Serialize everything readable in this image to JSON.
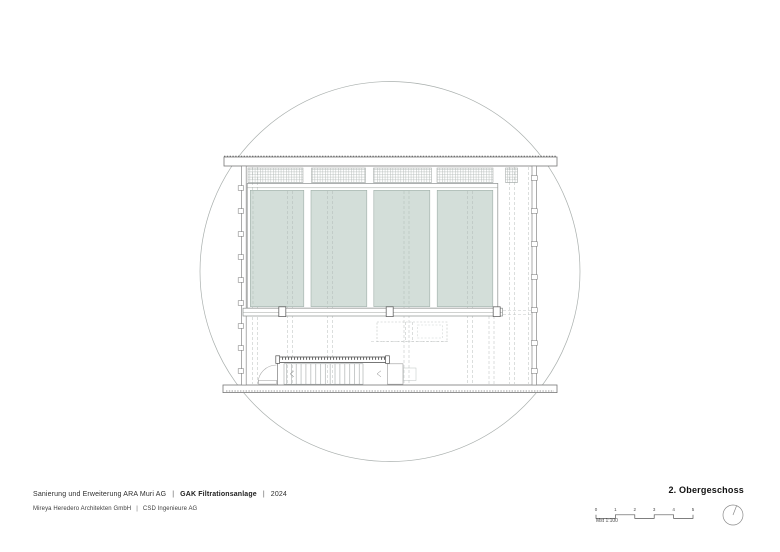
{
  "footer": {
    "project_line": {
      "client": "Sanierung und Erweiterung ARA Muri AG",
      "sep1": "|",
      "project": "GAK Filtrationsanlage",
      "sep2": "|",
      "year": "2024"
    },
    "firm_line": {
      "architect": "Mireya Heredero Architekten GmbH",
      "sep": "|",
      "engineer": "CSD Ingenieure AG"
    },
    "sheet_title": "2. Obergeschoss",
    "scale_bar": {
      "ticks": [
        "0",
        "1",
        "2",
        "3",
        "4",
        "5"
      ],
      "label": "Mst 1:100"
    },
    "north_arrow_icon": "compass-circle-with-needle"
  },
  "drawing": {
    "window_bays": 4,
    "glass_color": "#d3ded9",
    "line_color": "#7a7f7e",
    "crop_shape": "circle"
  }
}
